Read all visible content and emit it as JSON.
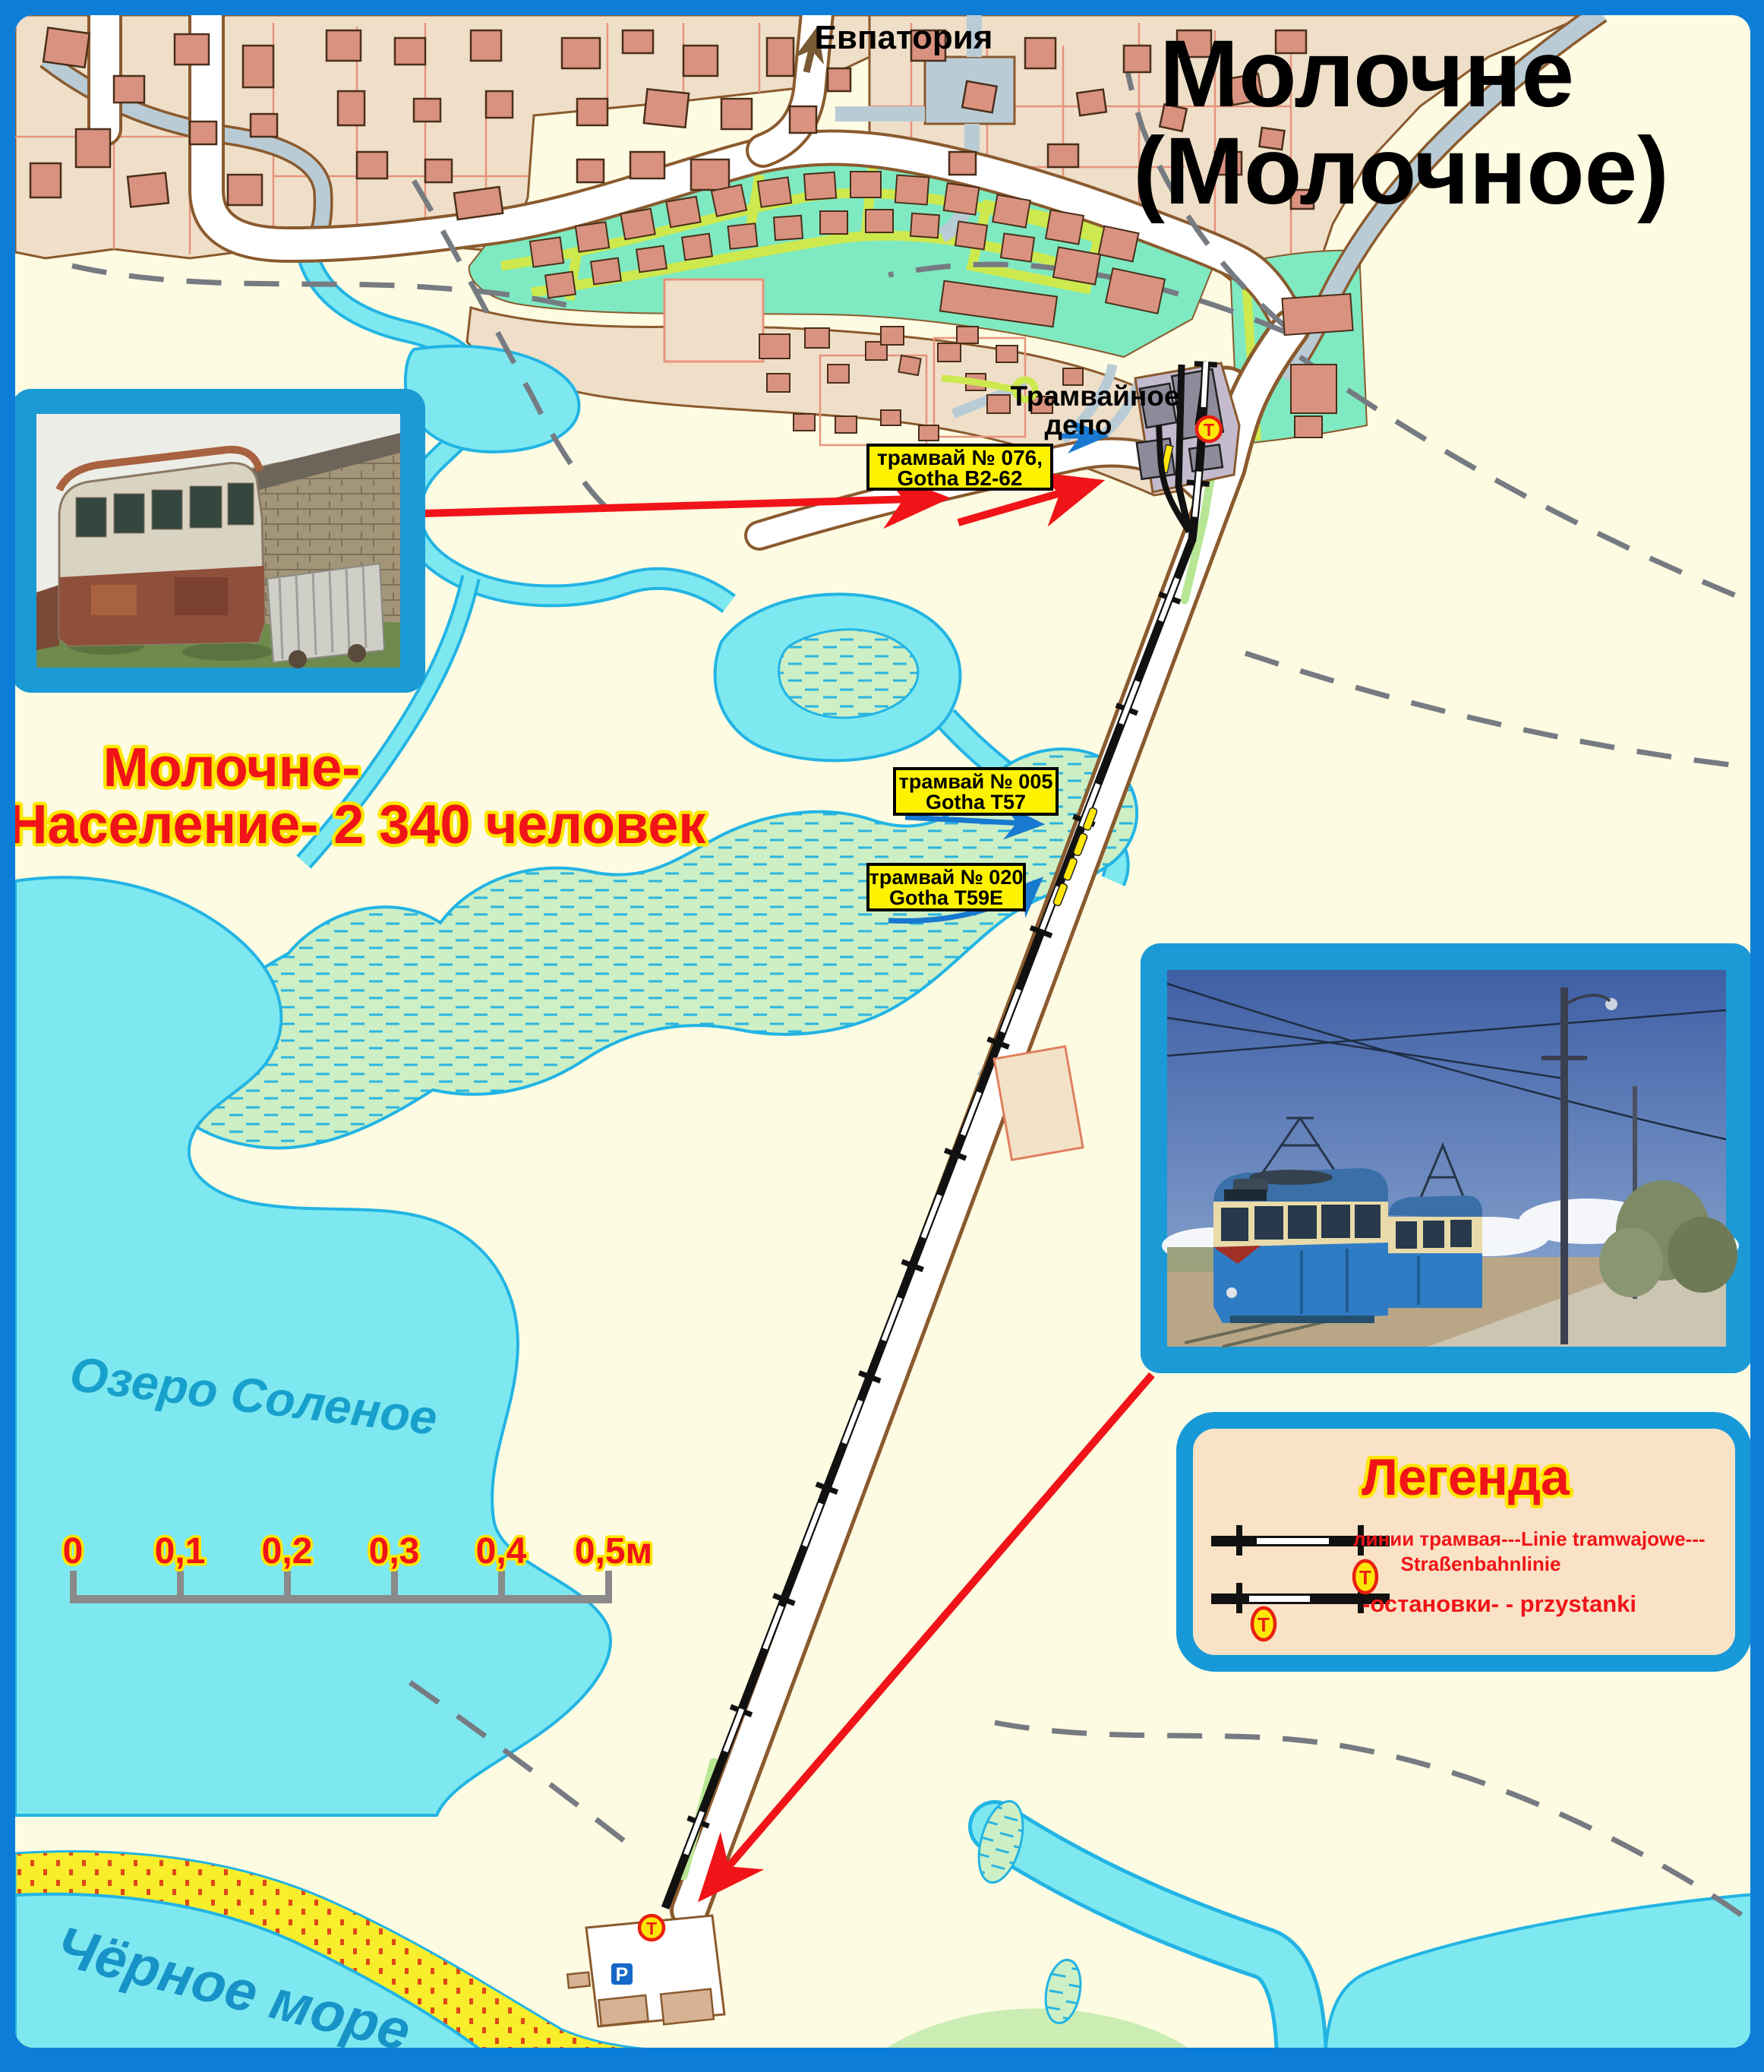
{
  "map": {
    "title_line1": "Молочне",
    "title_line2": "(Молочное)",
    "direction_label": "Евпатория",
    "depot_label_line1": "Трамвайное",
    "depot_label_line2": "депо",
    "population_line1": "Молочне-",
    "population_line2": "Население- 2 340 человек",
    "lake_label": "Озеро Соленое",
    "sea_label": "Чёрное море"
  },
  "tram_labels": {
    "tram076_line1": "трамвай № 076,",
    "tram076_line2": "Gotha B2-62",
    "tram005_line1": "трамвай № 005",
    "tram005_line2": "Gotha T57",
    "tram020_line1": "трамвай № 020",
    "tram020_line2": "Gotha T59E"
  },
  "markers": {
    "tram_stop": "T",
    "parking": "P"
  },
  "legend": {
    "title": "Легенда",
    "tram_line_label_line1": "линии трамвая---Linie tramwajowe---",
    "tram_line_label_line2": "Straßenbahnlinie",
    "stops_label": "-остановки- - przystanki"
  },
  "scale_bar": {
    "ticks": [
      "0",
      "0,1",
      "0,2",
      "0,3",
      "0,4",
      "0,5м"
    ]
  },
  "colors": {
    "frame_blue": "#0d7ed8",
    "photo_frame_blue": "#1b9ad6",
    "land_cream": "#fdfbe2",
    "village_beige": "#efdfc9",
    "building_salmon": "#d9927f",
    "water_cyan": "#7ee8f0",
    "water_outline": "#22b4e4",
    "canal_gray_blue": "#b9ccd6",
    "resort_mint": "#7fe9c1",
    "path_yellow_green": "#cde94e",
    "depot_lavender": "#c3bbcd",
    "beach_yellow": "#f8ee2b",
    "label_yellow": "#fff200",
    "accent_red": "#f01418",
    "arrow_blue": "#1879d0",
    "stop_marker_yellow": "#ffe60a",
    "stop_marker_red": "#e82010",
    "water_name_blue": "#18a0cc"
  }
}
